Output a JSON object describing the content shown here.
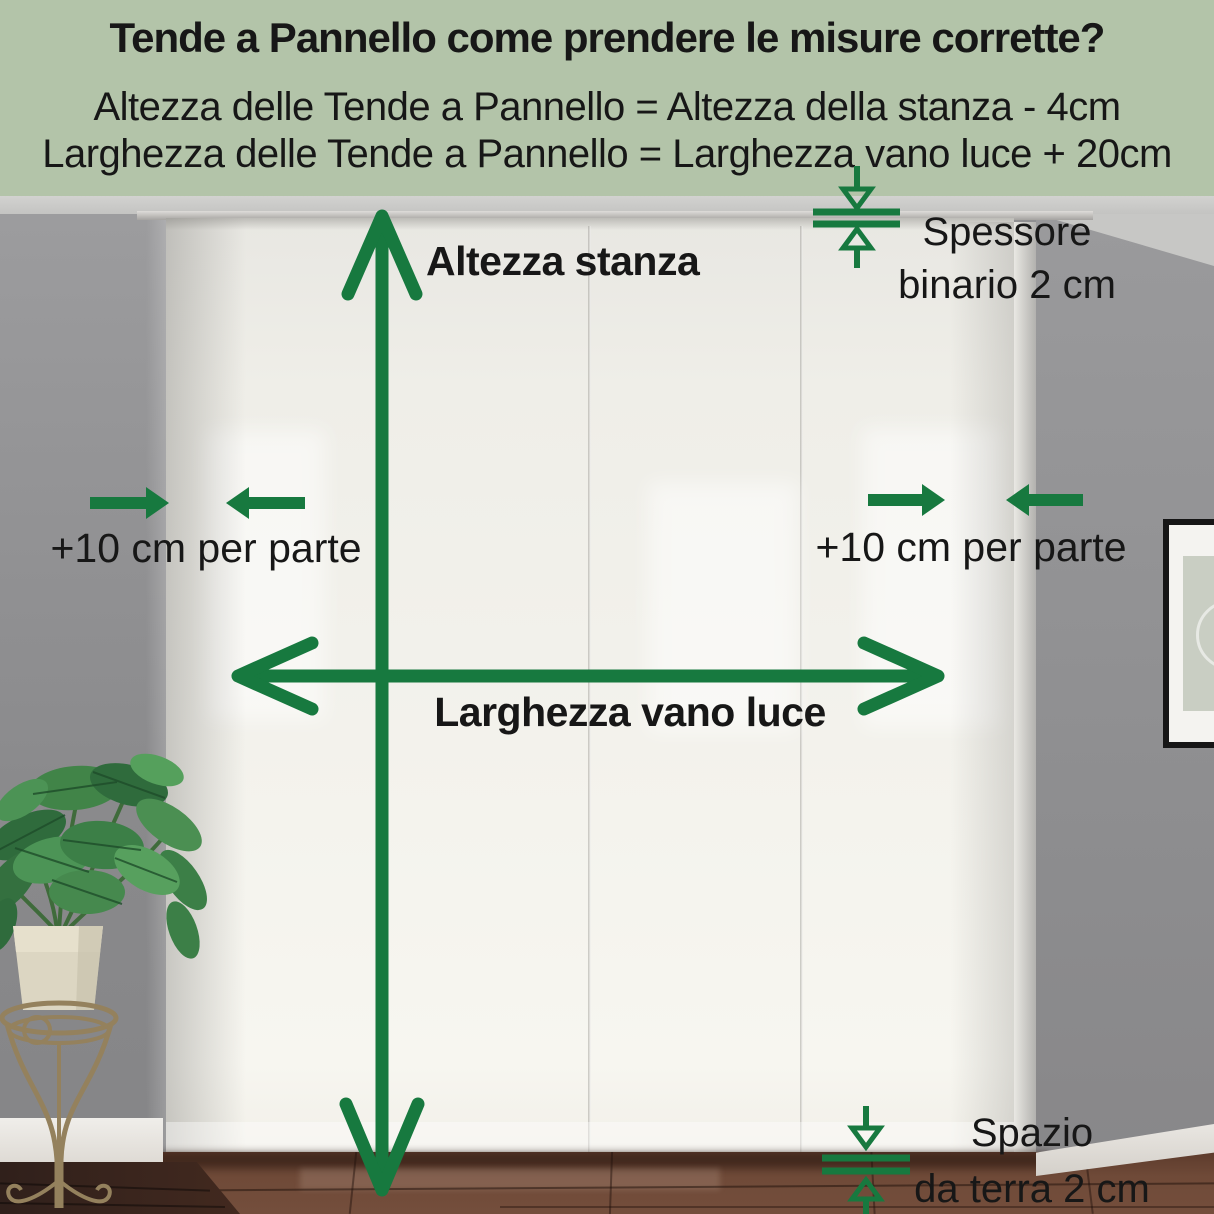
{
  "header": {
    "title": "Tende a Pannello come prendere le misure corrette?",
    "line1": "Altezza delle Tende a Pannello = Altezza della stanza - 4cm",
    "line2": "Larghezza delle Tende a Pannello = Larghezza vano luce + 20cm"
  },
  "annotations": {
    "altezza_stanza": "Altezza stanza",
    "larghezza_vano_luce": "Larghezza vano luce",
    "plus10_left": "+10 cm per parte",
    "plus10_right": "+10 cm per parte",
    "spessore_line1": "Spessore",
    "spessore_line2": "binario 2 cm",
    "spazio_line1": "Spazio",
    "spazio_line2": "da terra 2 cm"
  },
  "icons": {
    "room_height": "double-arrow-vertical",
    "opening_width": "double-arrow-horizontal",
    "side_margins": "opposing-filled-arrows",
    "rail_thickness": "gap-measure-arrows",
    "floor_gap": "gap-measure-arrows"
  },
  "colors": {
    "header-bg": "#b3c4a9",
    "ink": "#171717",
    "green": "#17793f",
    "curtain": "#f1efe8",
    "wall-left": "#8e8e90",
    "wall-right": "#909092",
    "ceiling": "#c9c9c7",
    "floor-tile": "#6b4737",
    "floor-wood": "#3b2520",
    "baseboard": "#e7e4df",
    "frame": "#161616",
    "pot": "#dcd6c2",
    "stand": "#94815d",
    "leaf-dark": "#2f6b3c",
    "leaf-mid": "#418448",
    "leaf-light": "#5d9c5f"
  }
}
